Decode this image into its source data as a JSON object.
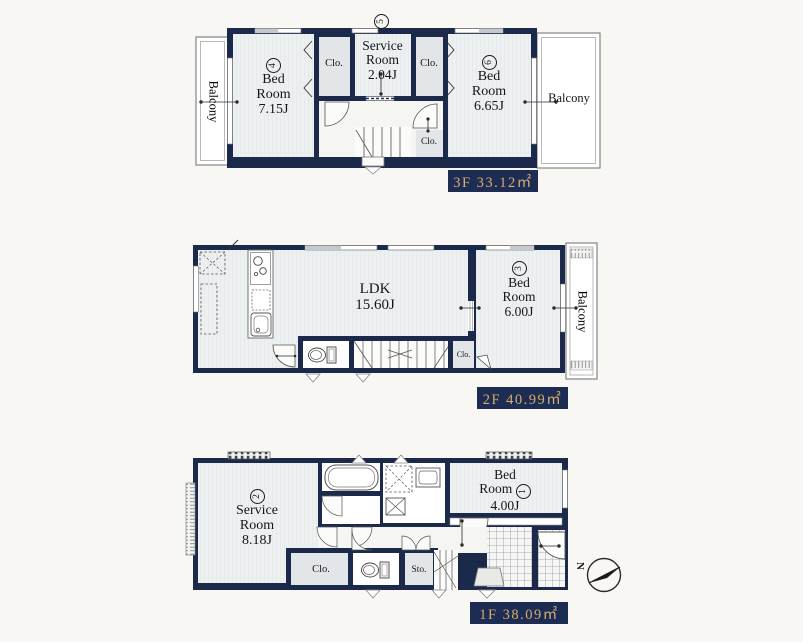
{
  "colors": {
    "wall": "#1b2a4a",
    "label_bg": "#1d2c52",
    "label_fg": "#d6ad6e"
  },
  "floor3": {
    "area": "3F 33.12㎡",
    "marker": "5",
    "balcony_left": "Balcony",
    "balcony_right": "Balcony",
    "bedroom4": {
      "num": "4",
      "l1": "Bed",
      "l2": "Room",
      "l3": "7.15J"
    },
    "closet_left": "Clo.",
    "service": {
      "l1": "Service",
      "l2": "Room",
      "l3": "2.04J"
    },
    "closet_right": "Clo.",
    "bedroom6": {
      "num": "6",
      "l1": "Bed",
      "l2": "Room",
      "l3": "6.65J"
    },
    "closet_hall": "Clo."
  },
  "floor2": {
    "area": "2F 40.99㎡",
    "ldk": {
      "l1": "LDK",
      "l2": "15.60J"
    },
    "bedroom3": {
      "num": "3",
      "l1": "Bed",
      "l2": "Room",
      "l3": "6.00J"
    },
    "closet_hall": "Clo.",
    "balcony_right": "Balcony"
  },
  "floor1": {
    "area": "1F 38.09㎡",
    "service": {
      "num": "2",
      "l1": "Service",
      "l2": "Room",
      "l3": "8.18J"
    },
    "bedroom1": {
      "num": "1",
      "l1": "Bed",
      "l2": "Room",
      "l3": "4.00J"
    },
    "closet": "Clo.",
    "storage": "Sto.",
    "north": "N"
  }
}
